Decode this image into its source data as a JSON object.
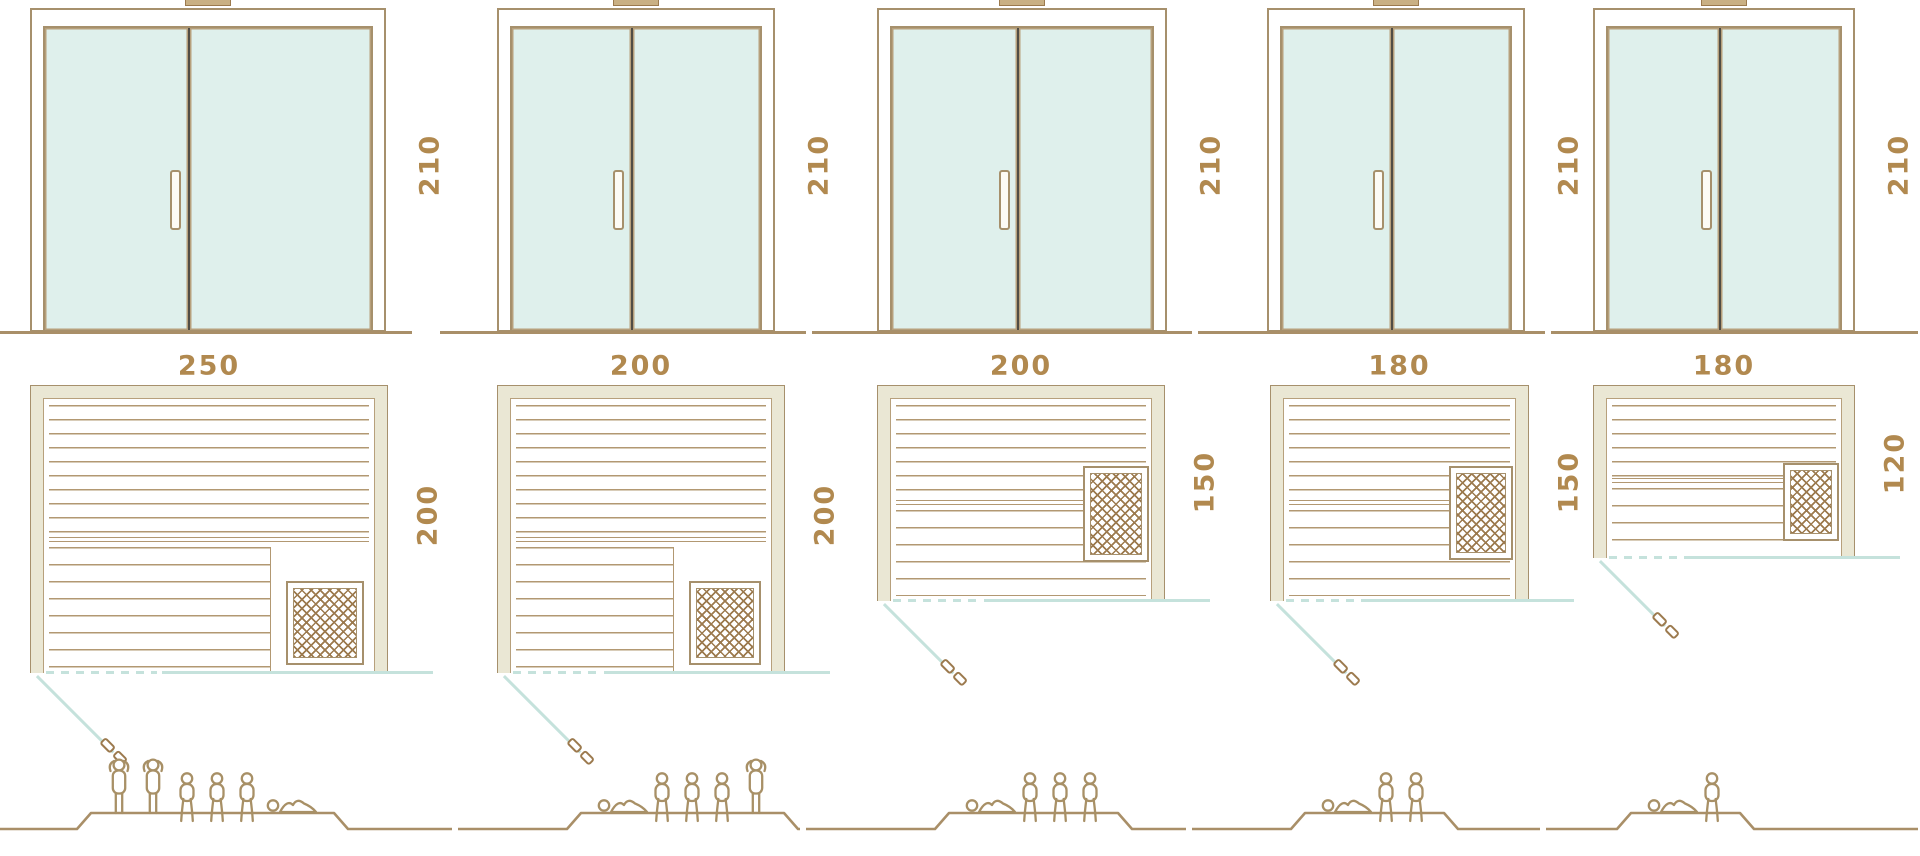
{
  "diagram": {
    "subject": "sauna-cabin-size-comparison",
    "views_per_unit": [
      "front-door-elevation",
      "floor-plan",
      "capacity-figures"
    ]
  },
  "colors": {
    "outline": "#a6906c",
    "outline_light": "#b7a07c",
    "text": "#b1894f",
    "glass": "#dff0ec",
    "wall_fill": "#eae7d4",
    "slat": "#b29872",
    "divider_dark": "#514d45",
    "teal": "#c5e2dc",
    "heater_grid": "#9c7a4e",
    "people": "#a89066",
    "ground": "#a98f68"
  },
  "units": [
    {
      "door_height_cm": "210",
      "width_cm": "250",
      "depth_cm": "200",
      "heater_position": "front-right",
      "figures": [
        "standing",
        "standing",
        "sitting",
        "sitting",
        "sitting",
        "lying"
      ]
    },
    {
      "door_height_cm": "210",
      "width_cm": "200",
      "depth_cm": "200",
      "heater_position": "front-right",
      "figures": [
        "lying",
        "sitting",
        "sitting",
        "sitting",
        "standing"
      ]
    },
    {
      "door_height_cm": "210",
      "width_cm": "200",
      "depth_cm": "150",
      "heater_position": "side-right",
      "figures": [
        "lying",
        "sitting",
        "sitting",
        "sitting"
      ]
    },
    {
      "door_height_cm": "210",
      "width_cm": "180",
      "depth_cm": "150",
      "heater_position": "side-right",
      "figures": [
        "lying",
        "sitting",
        "sitting"
      ]
    },
    {
      "door_height_cm": "210",
      "width_cm": "180",
      "depth_cm": "120",
      "heater_position": "side-right",
      "figures": [
        "lying",
        "sitting"
      ]
    }
  ]
}
